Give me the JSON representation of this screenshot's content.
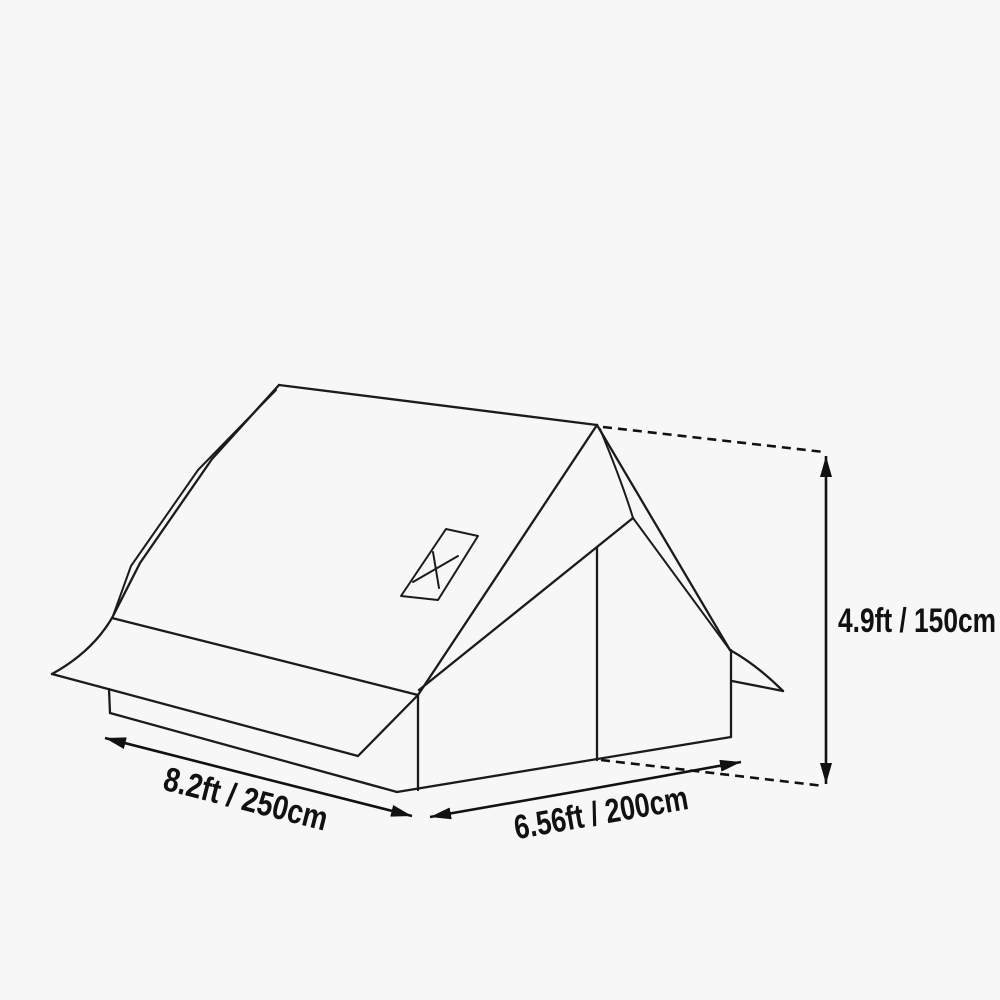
{
  "page": {
    "background_color": "#f7f7f7",
    "line_color": "#1b1b1b"
  },
  "diagram": {
    "type": "product-dimension-line-drawing",
    "subject": "A-frame cabin tent with awning skirt, front door panel and roof vent window",
    "dimensions": {
      "width": {
        "label": "8.2ft / 250cm",
        "feet": "8.2ft",
        "centimeters": "250cm"
      },
      "depth": {
        "label": "6.56ft / 200cm",
        "feet": "6.56ft",
        "centimeters": "200cm"
      },
      "height": {
        "label": "4.9ft / 150cm",
        "feet": "4.9ft",
        "centimeters": "150cm"
      }
    },
    "icons": [
      {
        "name": "x-mark-icon",
        "meaning": "roof vent window marking"
      }
    ]
  }
}
